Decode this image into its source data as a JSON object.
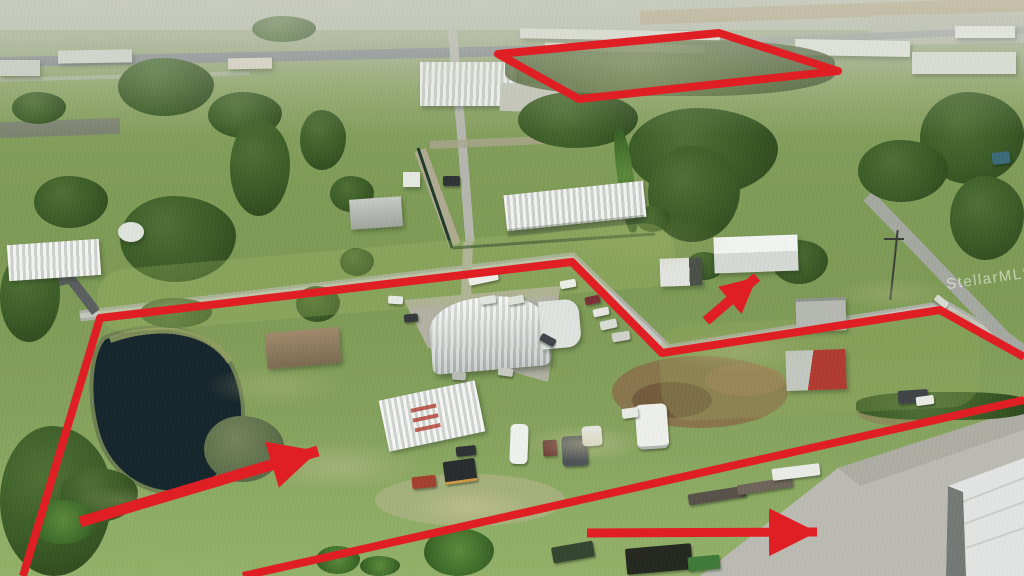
{
  "photo": {
    "type": "aerial-drone-photograph",
    "description": "Aerial view of acreage with pond, quonset barn, outbuildings, campers and pastures; red lines outline the parcels and red arrows highlight features.",
    "watermark": "StellarMLS"
  },
  "annotations": {
    "color": "#e01f25",
    "main_parcel_boundary": {
      "points": "23,576 100,318 572,262 662,353 940,310 1024,357"
    },
    "lower_boundary_line": {
      "points": "243,576 1024,400"
    },
    "secondary_parcel_outline": {
      "points": "498,54 719,33 838,71 579,99"
    },
    "arrows": [
      {
        "label": "pasture-arrow",
        "points": "80,522 318,451"
      },
      {
        "label": "outbuilding-arrow",
        "points": "706,321 757,277"
      },
      {
        "label": "driveway-arrow",
        "points": "587,533 817,532"
      }
    ]
  },
  "palette": {
    "grass": "#7f9b58",
    "dry_grass": "#b5ad79",
    "trees": "#3c5a28",
    "pond_water": "#15252c",
    "roads": "#aeb0a8",
    "buildings": "#e8eae6",
    "gravel": "#b6b3a8",
    "red_barn": "#b13a30"
  }
}
